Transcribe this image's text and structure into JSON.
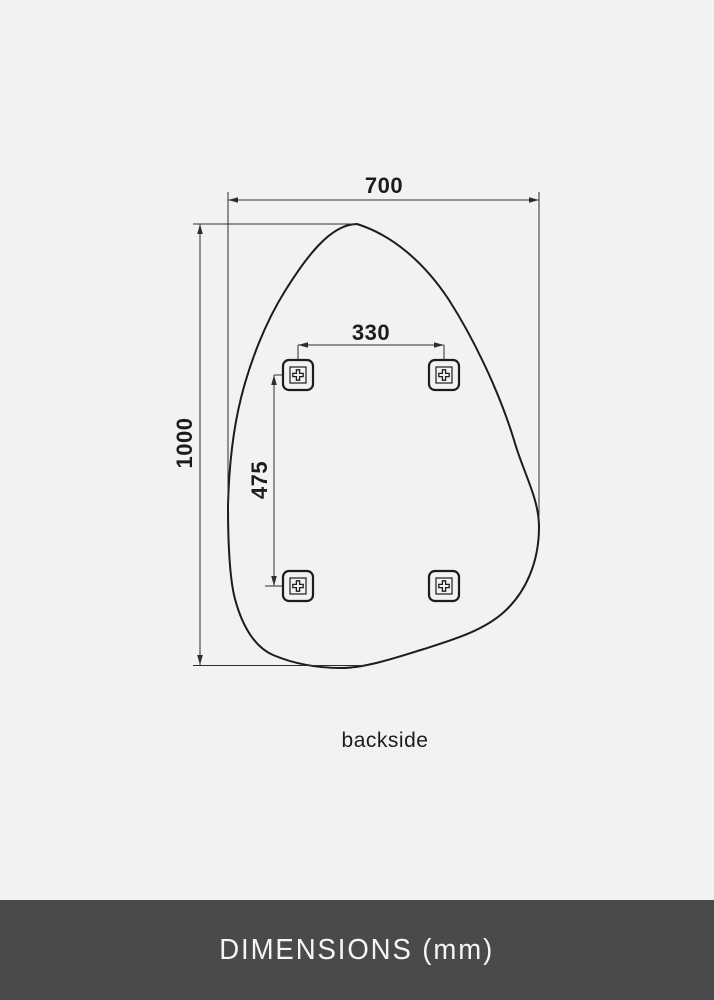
{
  "drawing": {
    "view_label": "backside",
    "dimensions": {
      "overall_width_mm": "700",
      "overall_height_mm": "1000",
      "bracket_spacing_horizontal_mm": "330",
      "bracket_spacing_vertical_mm": "475"
    },
    "icons": {
      "mounting_bracket": "rounded-square-bracket-with-cross-screw"
    }
  },
  "footer": {
    "label": "DIMENSIONS (mm)"
  },
  "colors": {
    "background": "#f2f2f2",
    "line": "#1c1c1c",
    "dim_line": "#2e2e2e",
    "footer_background": "#4a4a4c",
    "footer_text": "#f5f5f5"
  }
}
